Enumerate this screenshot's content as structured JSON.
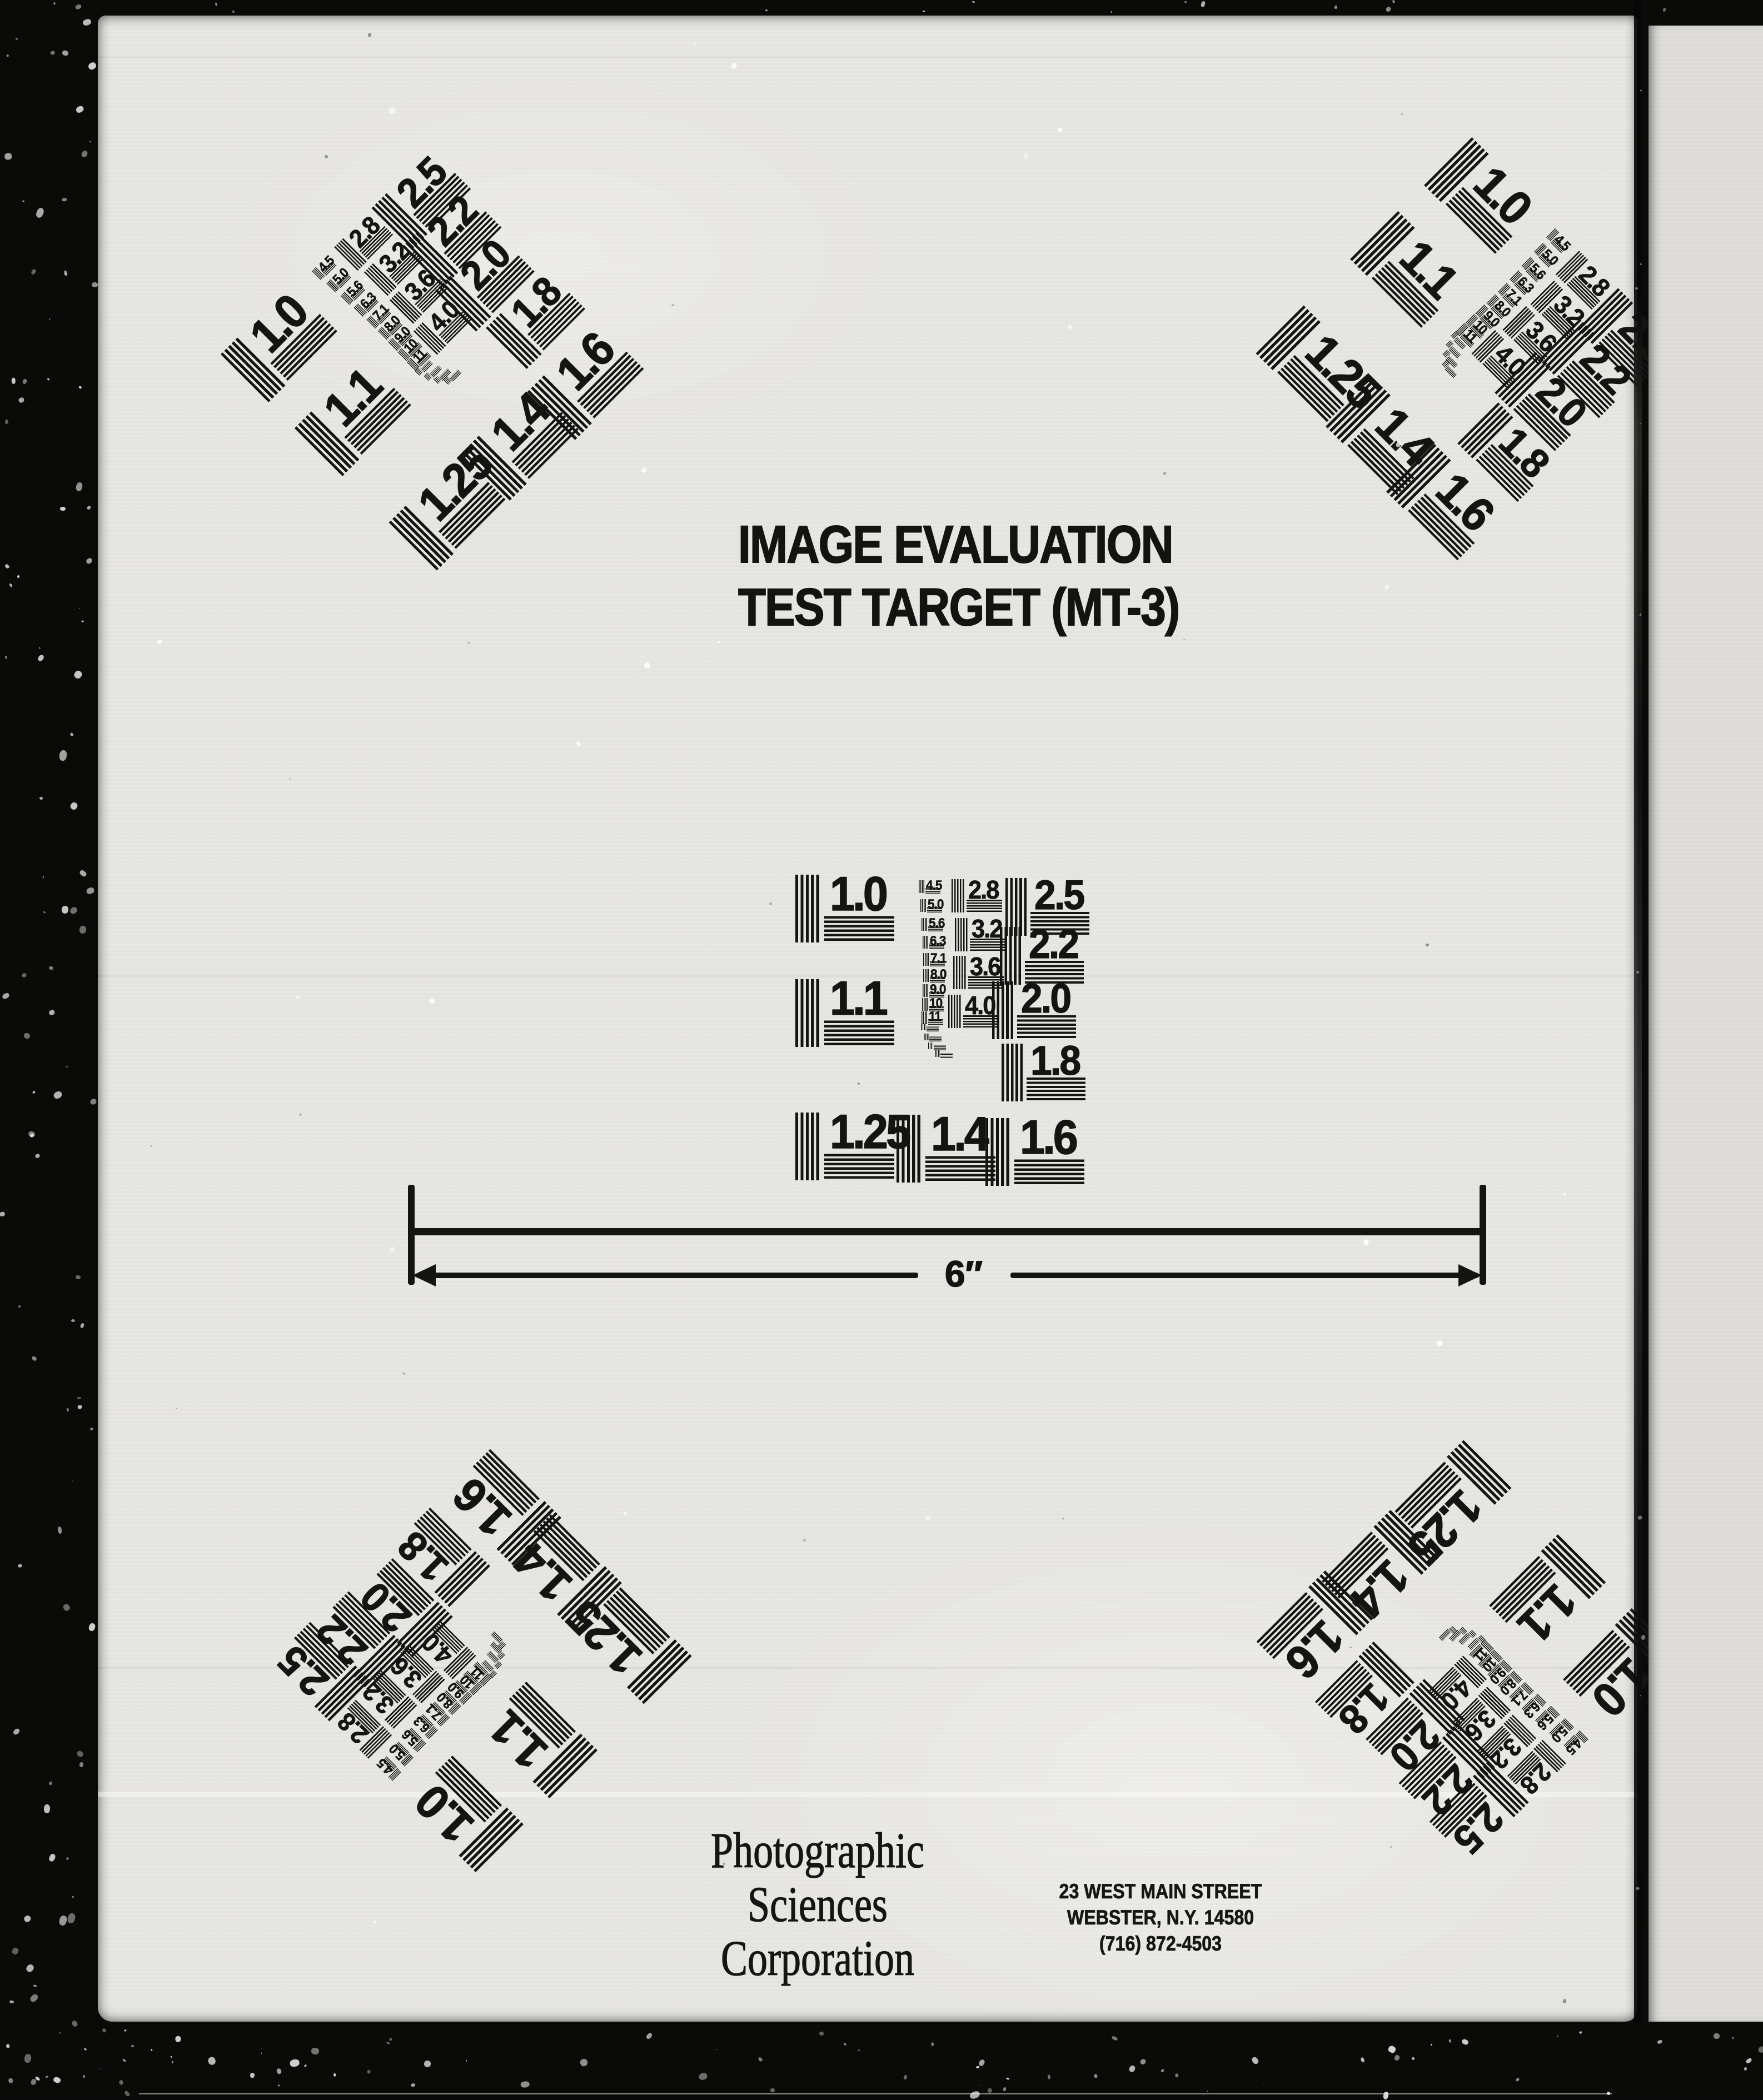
{
  "page": {
    "title_lines": [
      "IMAGE EVALUATION",
      "TEST TARGET (MT-3)"
    ],
    "ruler_label": "6″",
    "company_lines": [
      "Photographic",
      "Sciences",
      "Corporation"
    ],
    "address_lines": [
      "23 WEST MAIN STREET",
      "WEBSTER, N.Y. 14580",
      "(716) 872-4503"
    ]
  },
  "test_pattern": {
    "positions": [
      "top-left",
      "top-right",
      "center",
      "bottom-left",
      "bottom-right"
    ],
    "values_primary": [
      "1.0",
      "1.1",
      "1.25",
      "1.4",
      "1.6"
    ],
    "values_secondary": [
      "2.5",
      "2.2",
      "2.0",
      "1.8"
    ],
    "values_medium": [
      "2.8",
      "3.2",
      "3.6",
      "4.0"
    ],
    "values_small": [
      "4.5",
      "5.0",
      "5.6",
      "6.3",
      "7.1",
      "8.0",
      "9.0",
      "10",
      "11"
    ]
  },
  "colors": {
    "ink": "#141413",
    "page": "#e7e6e2",
    "backdrop": "#0a0a09",
    "side_strip": "#deddda"
  }
}
